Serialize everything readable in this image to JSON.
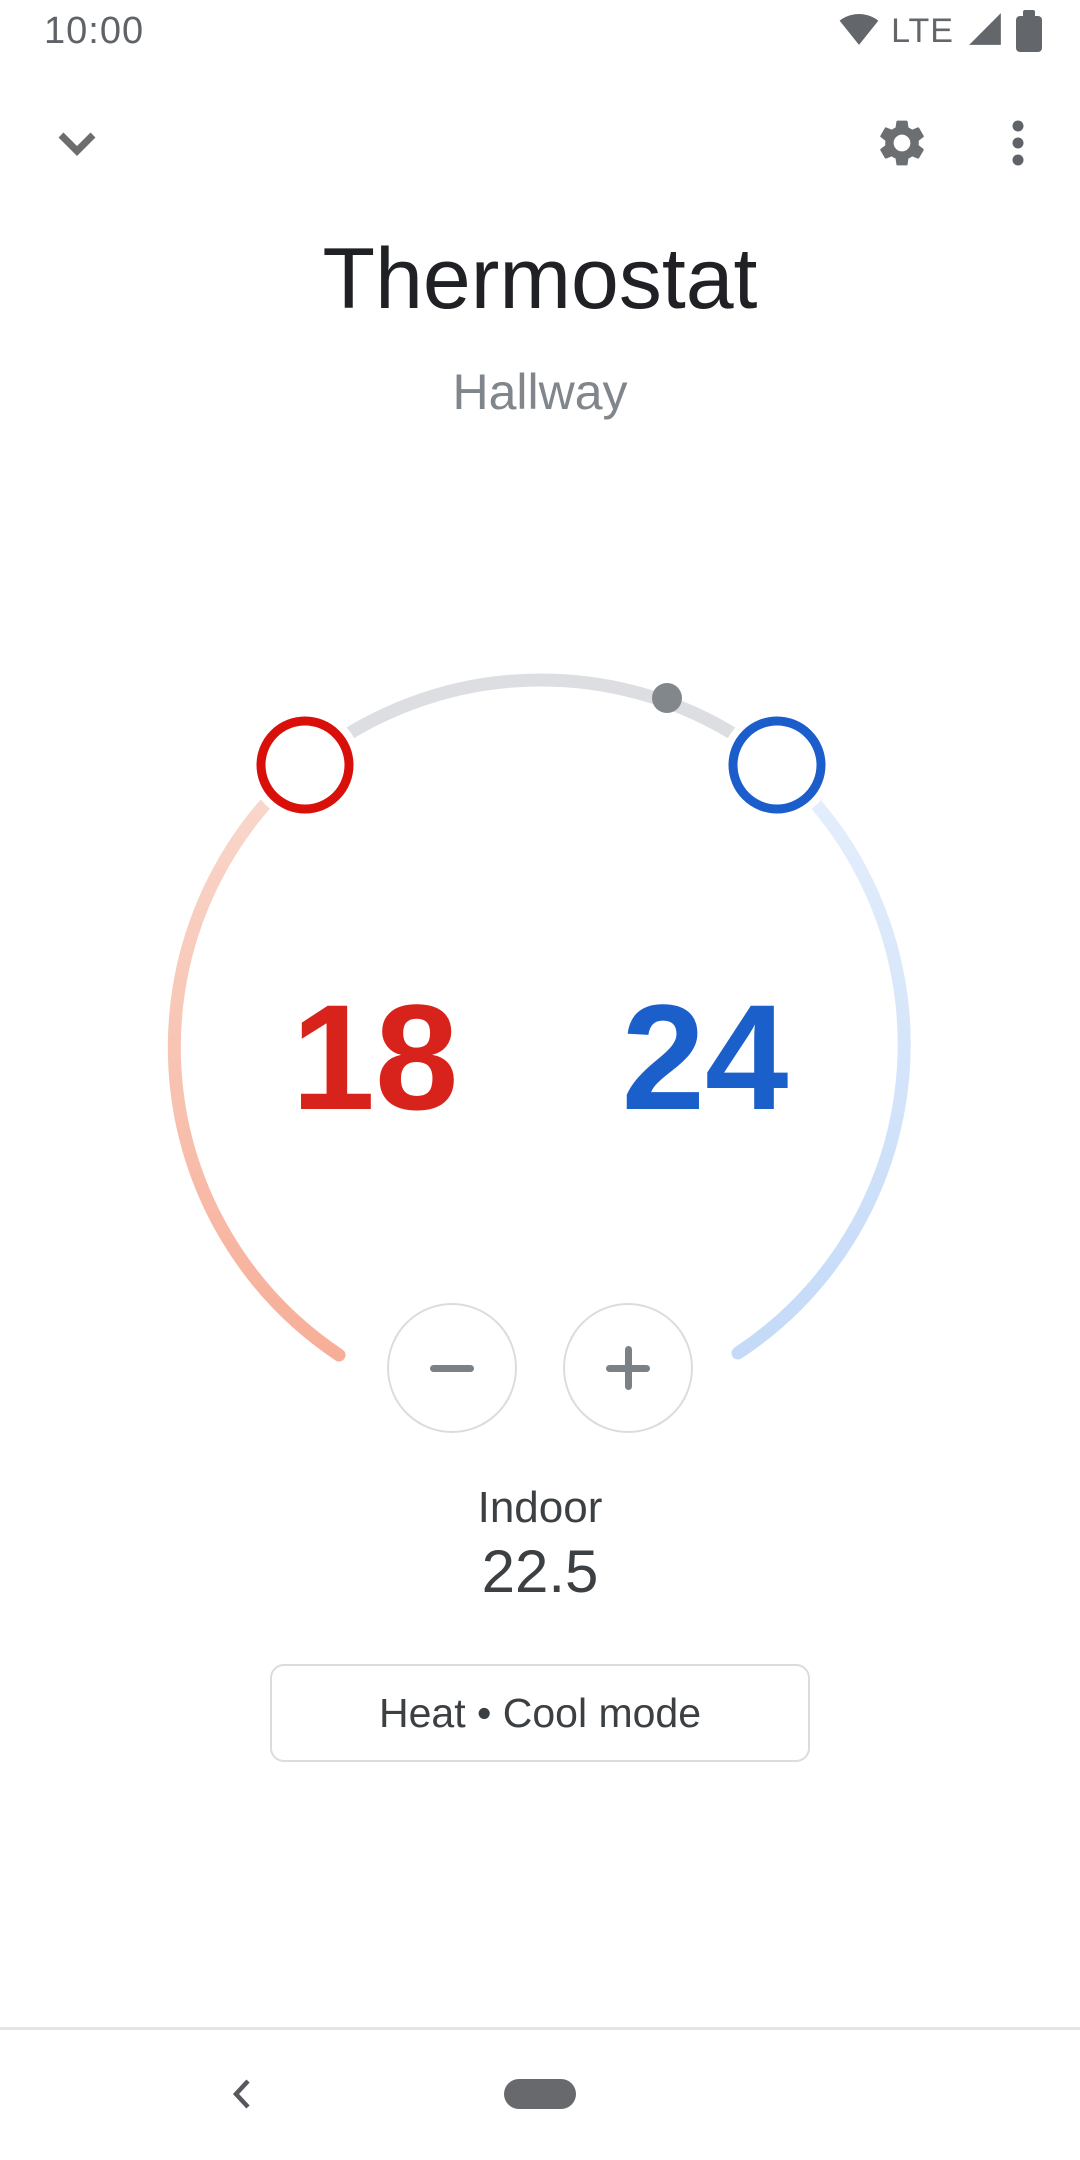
{
  "status_bar": {
    "time": "10:00",
    "network": "LTE",
    "icon_names": [
      "wifi-icon",
      "signal-icon",
      "battery-icon"
    ]
  },
  "header": {
    "title": "Thermostat",
    "subtitle": "Hallway",
    "icon_names": [
      "chevron-down-icon",
      "gear-icon",
      "more-vert-icon"
    ]
  },
  "dial": {
    "heat_setpoint": "18",
    "cool_setpoint": "24",
    "colors": {
      "heat_handle": "#d90f0a",
      "heat_text": "#d8231d",
      "cool_handle": "#1b5ecb",
      "cool_text": "#1a5fca",
      "track": "#dcdee1",
      "current_dot": "#82878c",
      "heat_arc_start": "#f9d9ce",
      "heat_arc_end": "#f7ae98",
      "cool_arc_start": "#e6effc",
      "cool_arc_end": "#c3daf8"
    }
  },
  "steppers": {
    "decrease": "−",
    "increase": "+"
  },
  "indoor": {
    "label": "Indoor",
    "value": "22.5"
  },
  "mode_button": {
    "label": "Heat • Cool mode"
  },
  "nav_bar": {
    "icon_names": [
      "back-chevron-icon",
      "home-pill"
    ]
  }
}
